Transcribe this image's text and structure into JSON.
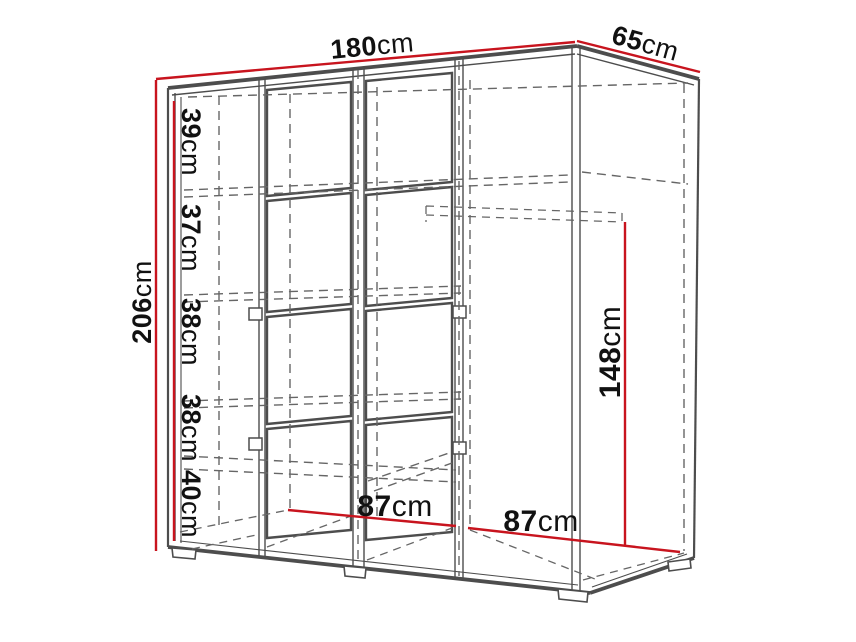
{
  "diagram": {
    "dimensions": {
      "width": {
        "value": "180",
        "unit": "cm"
      },
      "depth": {
        "value": "65",
        "unit": "cm"
      },
      "height": {
        "value": "206",
        "unit": "cm"
      },
      "compartments": [
        {
          "value": "39",
          "unit": "cm"
        },
        {
          "value": "37",
          "unit": "cm"
        },
        {
          "value": "38",
          "unit": "cm"
        },
        {
          "value": "38",
          "unit": "cm"
        },
        {
          "value": "40",
          "unit": "cm"
        }
      ],
      "hanging_height": {
        "value": "148",
        "unit": "cm"
      },
      "bottom_width_left": {
        "value": "87",
        "unit": "cm"
      },
      "bottom_width_right": {
        "value": "87",
        "unit": "cm"
      }
    },
    "colors": {
      "dimension_red": "#c8141e",
      "outline": "#4d4d4d",
      "hidden": "#666666",
      "text": "#111111",
      "background": "#ffffff"
    }
  }
}
